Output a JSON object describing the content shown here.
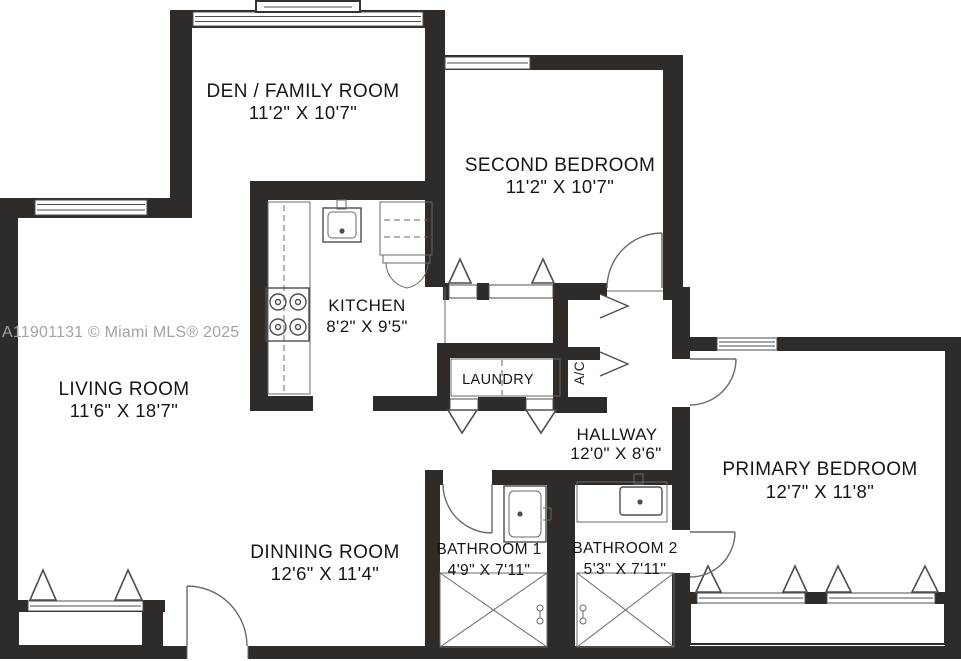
{
  "colors": {
    "wall": "#2e2b28",
    "line": "#4d4d4d",
    "text": "#161616",
    "watermark": "#a3a3a3",
    "bg": "#ffffff"
  },
  "watermark": "A11901131 © Miami MLS® 2025",
  "rooms": {
    "den": {
      "name": "DEN / FAMILY ROOM",
      "dims": "11'2\" X 10'7\""
    },
    "second_bedroom": {
      "name": "SECOND BEDROOM",
      "dims": "11'2\" X 10'7\""
    },
    "kitchen": {
      "name": "KITCHEN",
      "dims": "8'2\" X 9'5\""
    },
    "laundry": {
      "name": "LAUNDRY"
    },
    "ac_closet": {
      "name": "A/C"
    },
    "hallway": {
      "name": "HALLWAY",
      "dims": "12'0\" X 8'6\""
    },
    "living_room": {
      "name": "LIVING ROOM",
      "dims": "11'6\" X 18'7\""
    },
    "primary_bedroom": {
      "name": "PRIMARY BEDROOM",
      "dims": "12'7\" X 11'8\""
    },
    "dining_room": {
      "name": "DINNING ROOM",
      "dims": "12'6\" X 11'4\""
    },
    "bathroom_1": {
      "name": "BATHROOM 1",
      "dims": "4'9\" X 7'11\""
    },
    "bathroom_2": {
      "name": "BATHROOM 2",
      "dims": "5'3\" X 7'11\""
    }
  }
}
